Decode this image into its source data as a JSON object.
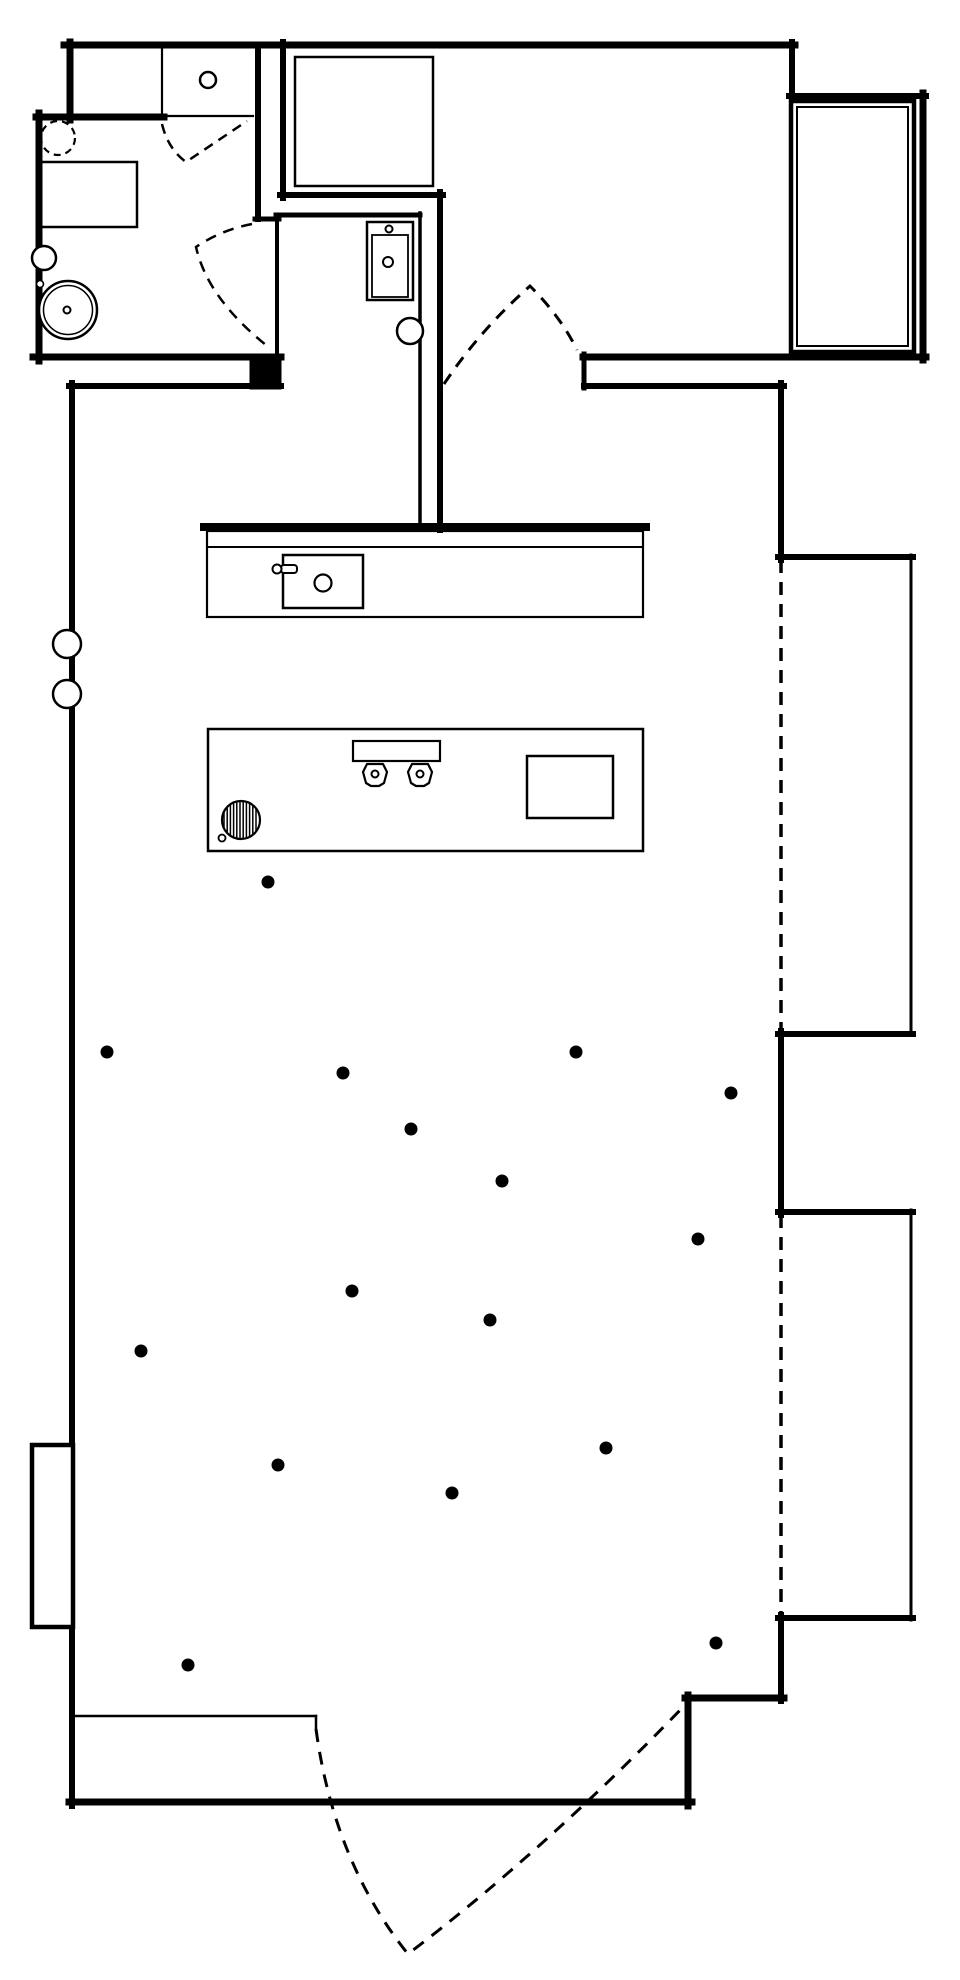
{
  "canvas": {
    "width": 960,
    "height": 1980,
    "background": "#ffffff",
    "line_color": "#000000"
  },
  "plan": {
    "shapes": [
      {
        "name": "top-wall",
        "type": "line",
        "x1": 64,
        "y1": 45,
        "x2": 795,
        "y2": 45,
        "w": 7
      },
      {
        "name": "upper-left-room-left-wall",
        "type": "line",
        "x1": 70,
        "y1": 42,
        "x2": 70,
        "y2": 120,
        "w": 7
      },
      {
        "name": "upper-left-room-divider",
        "type": "line",
        "x1": 162,
        "y1": 48,
        "x2": 162,
        "y2": 116,
        "w": 2.2
      },
      {
        "name": "upper-left-room-knob",
        "type": "circle",
        "cx": 208,
        "cy": 80,
        "r": 8,
        "w": 2.5
      },
      {
        "name": "bathroom-right-wall-upper",
        "type": "line",
        "x1": 258,
        "y1": 45,
        "x2": 258,
        "y2": 219,
        "w": 6
      },
      {
        "name": "bathroom-right-jog",
        "type": "line",
        "x1": 255,
        "y1": 219,
        "x2": 279,
        "y2": 219,
        "w": 5
      },
      {
        "name": "bathroom-door-edge-wall",
        "type": "line",
        "x1": 277,
        "y1": 219,
        "x2": 277,
        "y2": 357,
        "w": 4
      },
      {
        "name": "bathroom-top-wall",
        "type": "line",
        "x1": 36,
        "y1": 117,
        "x2": 164,
        "y2": 117,
        "w": 7
      },
      {
        "name": "bathroom-doorway-header",
        "type": "line",
        "x1": 162,
        "y1": 116,
        "x2": 253,
        "y2": 116,
        "w": 2.2
      },
      {
        "name": "bathroom-left-wall",
        "type": "line",
        "x1": 39,
        "y1": 113,
        "x2": 39,
        "y2": 361,
        "w": 7
      },
      {
        "name": "bathroom-bottom-wall",
        "type": "line",
        "x1": 33,
        "y1": 357,
        "x2": 281,
        "y2": 357,
        "w": 7
      },
      {
        "name": "bathroom-cavity-block",
        "type": "rect",
        "x": 250,
        "y": 354,
        "wd": 31,
        "ht": 35,
        "w": 1,
        "fill": "#000000"
      },
      {
        "name": "bathroom-lower-wall",
        "type": "line",
        "x1": 69,
        "y1": 386,
        "x2": 281,
        "y2": 386,
        "w": 6
      },
      {
        "name": "toilet-dashed-circle",
        "type": "circle",
        "cx": 58,
        "cy": 138,
        "r": 17,
        "w": 2.2,
        "dash": "7 5"
      },
      {
        "name": "vanity-counter",
        "type": "rect",
        "x": 38,
        "y": 162,
        "wd": 99,
        "ht": 65,
        "w": 2.5
      },
      {
        "name": "wall-circle-small",
        "type": "circle",
        "cx": 44,
        "cy": 258,
        "r": 12,
        "w": 2.5,
        "fill": "#ffffff"
      },
      {
        "name": "wall-circle-tiny",
        "type": "circle",
        "cx": 40,
        "cy": 284,
        "r": 3.5,
        "w": 1.6,
        "fill": "#ffffff"
      },
      {
        "name": "washing-machine-outer",
        "type": "circle",
        "cx": 68,
        "cy": 310,
        "r": 29,
        "w": 2.5,
        "fill": "#ffffff"
      },
      {
        "name": "washing-machine-inner",
        "type": "circle",
        "cx": 68,
        "cy": 310,
        "r": 24.5,
        "w": 1.5
      },
      {
        "name": "washing-machine-hub",
        "type": "circle",
        "cx": 67,
        "cy": 310,
        "r": 3.5,
        "w": 2
      },
      {
        "name": "closet-left-wall",
        "type": "line",
        "x1": 283,
        "y1": 42,
        "x2": 283,
        "y2": 198,
        "w": 6
      },
      {
        "name": "closet-bottom-wall",
        "type": "line",
        "x1": 280,
        "y1": 195,
        "x2": 443,
        "y2": 195,
        "w": 6
      },
      {
        "name": "wardrobe",
        "type": "rect",
        "x": 295,
        "y": 57,
        "wd": 138,
        "ht": 129,
        "w": 2.5
      },
      {
        "name": "hall-top-wall",
        "type": "line",
        "x1": 276,
        "y1": 215,
        "x2": 420,
        "y2": 215,
        "w": 5
      },
      {
        "name": "hall-right-wall-outer",
        "type": "line",
        "x1": 440,
        "y1": 192,
        "x2": 440,
        "y2": 530,
        "w": 6
      },
      {
        "name": "hall-right-wall-inner",
        "type": "line",
        "x1": 420,
        "y1": 213,
        "x2": 420,
        "y2": 527,
        "w": 3.5
      },
      {
        "name": "wall-basin-outer",
        "type": "rect",
        "x": 367,
        "y": 222,
        "wd": 46,
        "ht": 78,
        "w": 2.5
      },
      {
        "name": "wall-basin-inner",
        "type": "rect",
        "x": 372,
        "y": 235,
        "wd": 36,
        "ht": 62,
        "w": 1.8
      },
      {
        "name": "wall-basin-tap",
        "type": "circle",
        "cx": 389,
        "cy": 229,
        "r": 3.5,
        "w": 2,
        "fill": "#ffffff"
      },
      {
        "name": "wall-basin-drain",
        "type": "circle",
        "cx": 388,
        "cy": 262,
        "r": 5,
        "w": 2
      },
      {
        "name": "hall-door-knob",
        "type": "circle",
        "cx": 410,
        "cy": 331,
        "r": 13,
        "w": 2.5,
        "fill": "#ffffff"
      },
      {
        "name": "bedroom-step-vertical",
        "type": "line",
        "x1": 792,
        "y1": 42,
        "x2": 792,
        "y2": 99,
        "w": 6
      },
      {
        "name": "bedroom-step-horizontal",
        "type": "line",
        "x1": 789,
        "y1": 96,
        "x2": 926,
        "y2": 96,
        "w": 6
      },
      {
        "name": "bedroom-right-wall",
        "type": "line",
        "x1": 923,
        "y1": 93,
        "x2": 923,
        "y2": 360,
        "w": 7
      },
      {
        "name": "bed-outer",
        "type": "rect",
        "x": 791,
        "y": 101,
        "wd": 123,
        "ht": 251,
        "w": 4.5
      },
      {
        "name": "bed-inner",
        "type": "rect",
        "x": 797,
        "y": 107,
        "wd": 111,
        "ht": 239,
        "w": 2
      },
      {
        "name": "bedroom-bottom-wall",
        "type": "line",
        "x1": 583,
        "y1": 357,
        "x2": 926,
        "y2": 357,
        "w": 7
      },
      {
        "name": "bedroom-bottom-wall-end",
        "type": "line",
        "x1": 584,
        "y1": 354,
        "x2": 584,
        "y2": 388,
        "w": 5
      },
      {
        "name": "living-top-right-wall",
        "type": "line",
        "x1": 584,
        "y1": 386,
        "x2": 784,
        "y2": 386,
        "w": 6
      },
      {
        "name": "right-wall-upper",
        "type": "line",
        "x1": 781,
        "y1": 383,
        "x2": 781,
        "y2": 560,
        "w": 6
      },
      {
        "name": "bay1-top-wall",
        "type": "line",
        "x1": 778,
        "y1": 557,
        "x2": 913,
        "y2": 557,
        "w": 6
      },
      {
        "name": "bay1-right-edge",
        "type": "line",
        "x1": 911,
        "y1": 555,
        "x2": 911,
        "y2": 1035,
        "w": 3
      },
      {
        "name": "bay1-bottom-wall",
        "type": "line",
        "x1": 778,
        "y1": 1034,
        "x2": 913,
        "y2": 1034,
        "w": 6
      },
      {
        "name": "bay1-window-dashed",
        "type": "line",
        "x1": 781,
        "y1": 560,
        "x2": 781,
        "y2": 1031,
        "w": 3.5,
        "dash": "13 9",
        "cap": "butt"
      },
      {
        "name": "right-wall-mid",
        "type": "line",
        "x1": 781,
        "y1": 1031,
        "x2": 781,
        "y2": 1215,
        "w": 6
      },
      {
        "name": "bay2-top-wall",
        "type": "line",
        "x1": 778,
        "y1": 1212,
        "x2": 913,
        "y2": 1212,
        "w": 6
      },
      {
        "name": "bay2-right-edge",
        "type": "line",
        "x1": 911,
        "y1": 1210,
        "x2": 911,
        "y2": 1620,
        "w": 3
      },
      {
        "name": "bay2-bottom-wall",
        "type": "line",
        "x1": 778,
        "y1": 1618,
        "x2": 913,
        "y2": 1618,
        "w": 6
      },
      {
        "name": "bay2-window-dashed",
        "type": "line",
        "x1": 781,
        "y1": 1215,
        "x2": 781,
        "y2": 1615,
        "w": 3.5,
        "dash": "13 9",
        "cap": "butt"
      },
      {
        "name": "right-wall-lower",
        "type": "line",
        "x1": 781,
        "y1": 1615,
        "x2": 781,
        "y2": 1701,
        "w": 6
      },
      {
        "name": "entry-step-horizontal",
        "type": "line",
        "x1": 685,
        "y1": 1698,
        "x2": 784,
        "y2": 1698,
        "w": 7
      },
      {
        "name": "entry-step-vertical",
        "type": "line",
        "x1": 688,
        "y1": 1695,
        "x2": 688,
        "y2": 1806,
        "w": 7
      },
      {
        "name": "bottom-wall",
        "type": "line",
        "x1": 69,
        "y1": 1802,
        "x2": 692,
        "y2": 1802,
        "w": 7
      },
      {
        "name": "left-wall",
        "type": "line",
        "x1": 72,
        "y1": 383,
        "x2": 72,
        "y2": 1806,
        "w": 6
      },
      {
        "name": "left-wall-circle-1",
        "type": "circle",
        "cx": 67,
        "cy": 644,
        "r": 14,
        "w": 2.5,
        "fill": "#ffffff"
      },
      {
        "name": "left-wall-circle-2",
        "type": "circle",
        "cx": 67,
        "cy": 694,
        "r": 14,
        "w": 2.5,
        "fill": "#ffffff"
      },
      {
        "name": "left-window-bay",
        "type": "rect",
        "x": 32,
        "y": 1445,
        "wd": 41,
        "ht": 182,
        "w": 4.5,
        "fill": "#ffffff"
      },
      {
        "name": "entry-screen-line",
        "type": "line",
        "x1": 72,
        "y1": 1716,
        "x2": 316,
        "y2": 1716,
        "w": 2.5
      },
      {
        "name": "entry-screen-tick",
        "type": "line",
        "x1": 316,
        "y1": 1716,
        "x2": 316,
        "y2": 1729,
        "w": 2.5
      },
      {
        "name": "kitchen-wall",
        "type": "line",
        "x1": 204,
        "y1": 527,
        "x2": 646,
        "y2": 527,
        "w": 8
      },
      {
        "name": "kitchen-counter",
        "type": "rect",
        "x": 207,
        "y": 531,
        "wd": 436,
        "ht": 86,
        "w": 2.2
      },
      {
        "name": "kitchen-counter-backline",
        "type": "line",
        "x1": 207,
        "y1": 547,
        "x2": 643,
        "y2": 547,
        "w": 2
      },
      {
        "name": "kitchen-sink",
        "type": "rect",
        "x": 283,
        "y": 555,
        "wd": 80,
        "ht": 53,
        "w": 2.5
      },
      {
        "name": "kitchen-sink-drain",
        "type": "circle",
        "cx": 323,
        "cy": 583,
        "r": 8.5,
        "w": 2.2
      },
      {
        "name": "kitchen-faucet-handle",
        "type": "rect",
        "x": 281,
        "y": 565,
        "wd": 16,
        "ht": 8,
        "rx": 3,
        "w": 2,
        "fill": "#ffffff"
      },
      {
        "name": "kitchen-faucet-knob",
        "type": "circle",
        "cx": 277,
        "cy": 569,
        "r": 4.5,
        "w": 2,
        "fill": "#ffffff"
      },
      {
        "name": "kitchen-island",
        "type": "rect",
        "x": 208,
        "y": 729,
        "wd": 435,
        "ht": 122,
        "w": 2.5
      },
      {
        "name": "island-hob",
        "type": "hatch",
        "cx": 241,
        "cy": 820,
        "r": 19,
        "w": 2.2,
        "step": 3.2
      },
      {
        "name": "island-hob-ignitor",
        "type": "circle",
        "cx": 222,
        "cy": 838,
        "r": 3.5,
        "w": 1.8,
        "fill": "#ffffff"
      },
      {
        "name": "island-tray",
        "type": "rect",
        "x": 353,
        "y": 741,
        "wd": 87,
        "ht": 20,
        "w": 2.2
      },
      {
        "name": "burner-1",
        "type": "polygon",
        "points": "367,764 383,764 387,772 384,783 379,786 371,786 366,783 363,772",
        "w": 2.2,
        "fill": "#ffffff"
      },
      {
        "name": "burner-1-center",
        "type": "circle",
        "cx": 375,
        "cy": 774,
        "r": 3.5,
        "w": 2
      },
      {
        "name": "burner-2",
        "type": "polygon",
        "points": "412,764 428,764 432,772 429,783 424,786 416,786 411,783 408,772",
        "w": 2.2,
        "fill": "#ffffff"
      },
      {
        "name": "burner-2-center",
        "type": "circle",
        "cx": 420,
        "cy": 774,
        "r": 3.5,
        "w": 2
      },
      {
        "name": "island-board",
        "type": "rect",
        "x": 527,
        "y": 756,
        "wd": 86,
        "ht": 62,
        "w": 2.5
      },
      {
        "name": "upper-closet-door-dashed",
        "type": "path",
        "d": "M162,124 Q168,149 186,162 L247,121",
        "w": 2.5,
        "dash": "10 7"
      },
      {
        "name": "bathroom-door-dashed",
        "type": "path",
        "d": "M252,224 Q221,230 196,247 Q208,300 271,349",
        "w": 2.5,
        "dash": "11 8"
      },
      {
        "name": "bedroom-door-dashed",
        "type": "path",
        "d": "M444,384 Q480,330 530,286 Q561,317 577,350",
        "w": 3,
        "dash": "12 9"
      },
      {
        "name": "entry-door-dashed",
        "type": "path",
        "d": "M316,1729 Q334,1862 408,1954 Q545,1850 686,1704",
        "w": 3,
        "dash": "13 10"
      }
    ],
    "dots": {
      "r": 6.5,
      "points": [
        [
          268,
          882
        ],
        [
          107,
          1052
        ],
        [
          343,
          1073
        ],
        [
          576,
          1052
        ],
        [
          731,
          1093
        ],
        [
          411,
          1129
        ],
        [
          502,
          1181
        ],
        [
          698,
          1239
        ],
        [
          352,
          1291
        ],
        [
          490,
          1320
        ],
        [
          141,
          1351
        ],
        [
          606,
          1448
        ],
        [
          278,
          1465
        ],
        [
          452,
          1493
        ],
        [
          188,
          1665
        ],
        [
          716,
          1643
        ]
      ]
    }
  }
}
